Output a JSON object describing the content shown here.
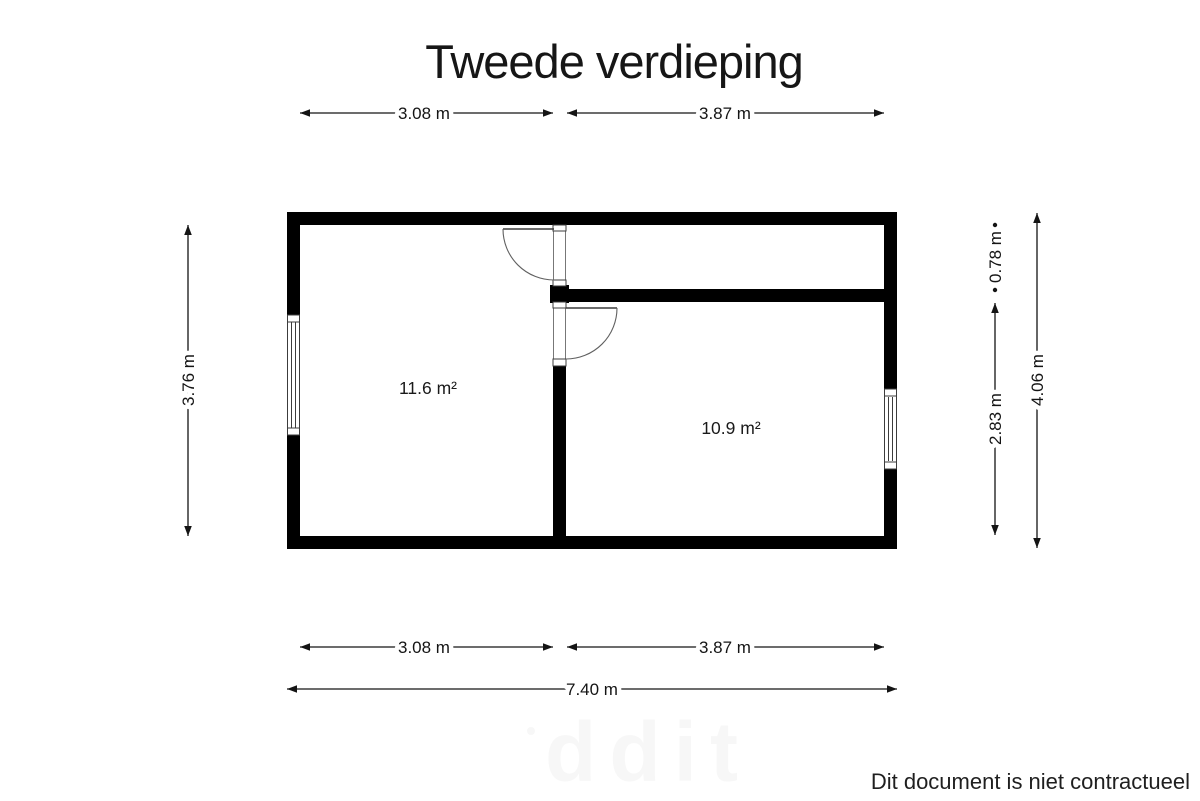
{
  "title": "Tweede verdieping",
  "floor_plan": {
    "rooms": [
      {
        "id": "left-room",
        "area_label": "11.6 m²"
      },
      {
        "id": "right-room",
        "area_label": "10.9 m²"
      }
    ],
    "dimensions": {
      "top_left_width": "3.08 m",
      "top_right_width": "3.87 m",
      "left_height": "3.76 m",
      "right_upper_height": "0.78 m",
      "right_lower_height": "2.83 m",
      "right_total_height": "4.06 m",
      "bottom_left_width": "3.08 m",
      "bottom_right_width": "3.87 m",
      "bottom_total_width": "7.40 m"
    }
  },
  "watermark": "ddit",
  "disclaimer": "Dit document is niet contractueel",
  "colors": {
    "background": "#ffffff",
    "wall": "#000000",
    "dimension_line": "#141414",
    "text": "#1a1a1a",
    "watermark": "#f7f7f7"
  }
}
